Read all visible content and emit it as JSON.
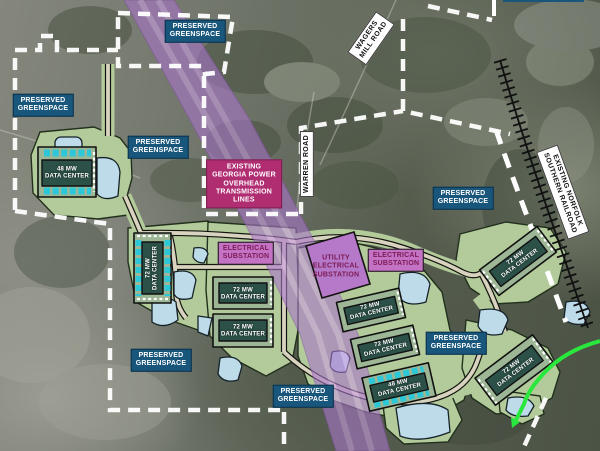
{
  "labels": {
    "greenspace": {
      "line1": "PRESERVED",
      "line2": "GREENSPACE"
    },
    "transmission": {
      "lines": [
        "EXISTING",
        "GEORGIA POWER",
        "OVERHEAD",
        "TRANSMISSION",
        "LINES"
      ]
    },
    "improvements_partial": "IMPROVEMENTS"
  },
  "substations": [
    {
      "lines": [
        "ELECTRICAL",
        "SUBSTATION"
      ]
    },
    {
      "lines": [
        "UTILITY",
        "ELECTRICAL",
        "SUBSTATION"
      ]
    },
    {
      "lines": [
        "ELECTRICAL",
        "SUBSTATION"
      ]
    }
  ],
  "data_centers": [
    {
      "capacity_mw": 48,
      "line1": "48 MW",
      "line2": "DATA CENTER"
    },
    {
      "capacity_mw": 72,
      "line1": "72 MW",
      "line2": "DATA CENTER"
    },
    {
      "capacity_mw": 72,
      "line1": "72 MW",
      "line2": "DATA CENTER"
    },
    {
      "capacity_mw": 72,
      "line1": "72 MW",
      "line2": "DATA CENTER"
    },
    {
      "capacity_mw": 72,
      "line1": "72 MW",
      "line2": "DATA CENTER"
    },
    {
      "capacity_mw": 72,
      "line1": "72 MW",
      "line2": "DATA CENTER"
    },
    {
      "capacity_mw": 48,
      "line1": "48 MW",
      "line2": "DATA CENTER"
    },
    {
      "capacity_mw": 72,
      "line1": "72 MW",
      "line2": "DATA CENTER"
    },
    {
      "capacity_mw": 72,
      "line1": "72 MW",
      "line2": "DATA CENTER"
    }
  ],
  "roads": [
    {
      "id": "wagers-mill-road",
      "lines": [
        "WAGERS",
        "MILL ROAD"
      ]
    },
    {
      "id": "warren-road",
      "lines": [
        "WARREN ROAD"
      ]
    },
    {
      "id": "norfolk-southern-railroad",
      "lines": [
        "EXISTING NORFOLK",
        "SOUTHERN RAILROAD"
      ]
    }
  ],
  "colors": {
    "greenspace_bg": "#19567C",
    "transmission_bg": "#B02D72",
    "substation_bg": "#C473C4",
    "substation_text": "#7C1B55",
    "corridor": "#A875C9",
    "corridor_stripe": "#D2A8EA",
    "pad": "#B3CB9A",
    "pond": "#BEDBE9",
    "building_dark": "#2C5148",
    "building_pad": "#9DB695",
    "road_fill": "#D8D3BF",
    "boundary": "#FFFFFF",
    "route_green": "#29E73C",
    "cooling_cyan": "#2CC8D8"
  }
}
